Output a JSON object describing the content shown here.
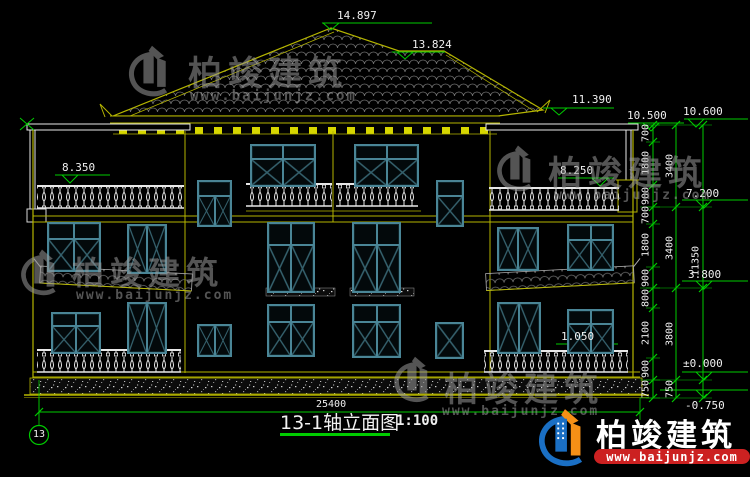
{
  "drawing": {
    "title": "13-1轴立面图",
    "scale": "1:100",
    "axis_bubble": "13"
  },
  "elevations": {
    "roof_apex": "14.897",
    "roof_ridge": "13.824",
    "roof_eave": "11.390",
    "wing_slab": "10.500",
    "parapet_top": "10.600",
    "terrace_rail_left": "8.350",
    "terrace_rail_right": "8.250",
    "third_floor": "7.200",
    "second_floor": "3.800",
    "ground_floor": "±0.000",
    "site_ground": "-0.750",
    "window_sill": "1.050"
  },
  "dimensions": {
    "overall_width": "25400",
    "total_height": "11350",
    "right_inner": [
      "700",
      "1800",
      "900",
      "700",
      "1800",
      "900",
      "800",
      "2100",
      "900",
      "750"
    ],
    "right_mid": [
      "3400",
      "3400",
      "3800",
      "750"
    ]
  },
  "watermark": {
    "brand": "柏竣建筑",
    "url": "www.baijunjz.com"
  },
  "logo": {
    "brand": "柏竣建筑",
    "url": "www.baijunjz.com"
  },
  "colors": {
    "line_yellow": "#b5b500",
    "line_green": "#00cc00",
    "line_white": "#e8e8e8",
    "window_teal": "#4a8596",
    "logo_blue": "#1a6fc4",
    "logo_orange": "#f59016",
    "url_band_red": "#cc2121"
  }
}
